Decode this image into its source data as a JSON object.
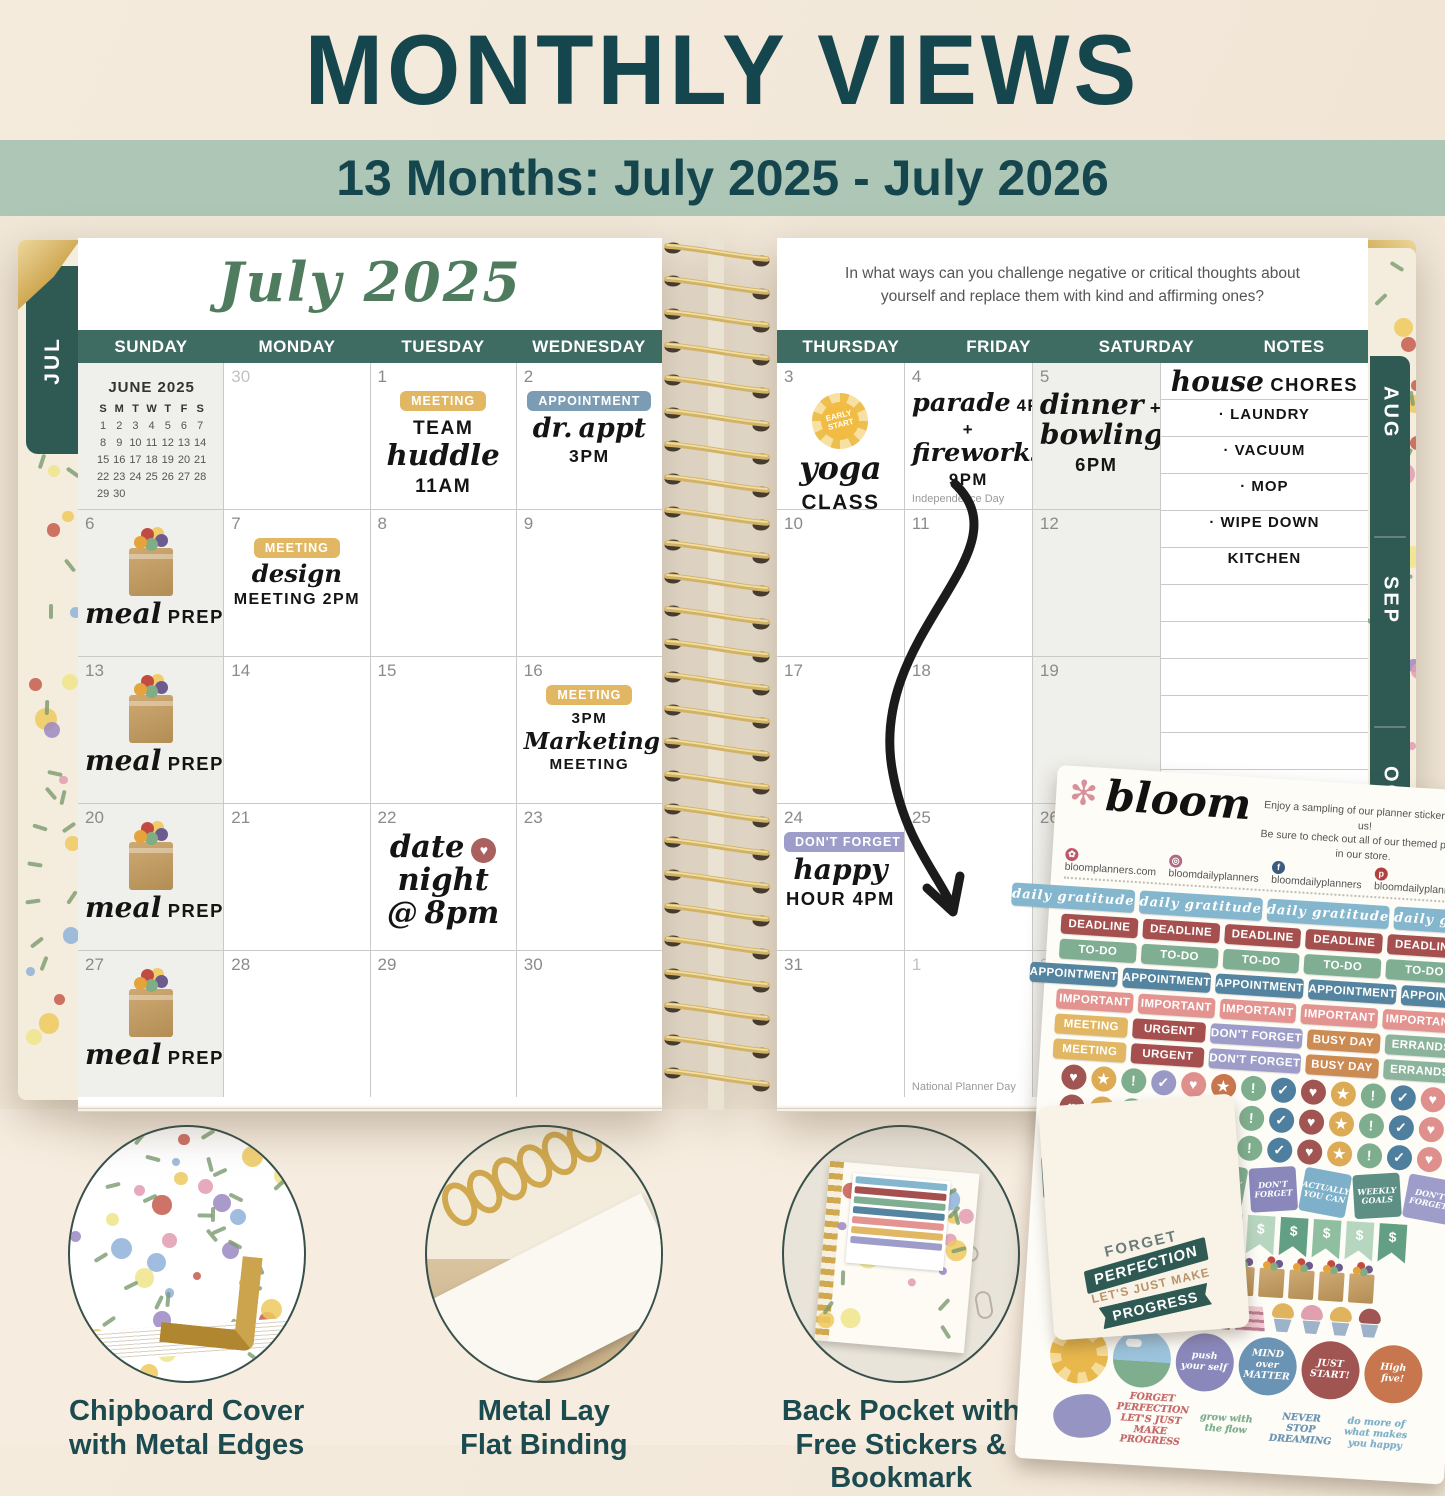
{
  "header": {
    "title": "MONTHLY VIEWS",
    "subtitle": "13 Months: July 2025 - July 2026"
  },
  "palette": {
    "title_teal": "#15454d",
    "band_green": "#adc6b5",
    "header_teal": "#3e6b62",
    "tab_teal": "#2f5a54",
    "script_green": "#4f7b5e",
    "gold_binding": "#d2b366"
  },
  "left_page": {
    "tab": "JUL",
    "month_title": "July 2025",
    "day_headers": [
      "SUNDAY",
      "MONDAY",
      "TUESDAY",
      "WEDNESDAY"
    ],
    "mini_calendar": {
      "title": "JUNE 2025",
      "day_letters": [
        "S",
        "M",
        "T",
        "W",
        "T",
        "F",
        "S"
      ],
      "weeks": [
        [
          "1",
          "2",
          "3",
          "4",
          "5",
          "6",
          "7"
        ],
        [
          "8",
          "9",
          "10",
          "11",
          "12",
          "13",
          "14"
        ],
        [
          "15",
          "16",
          "17",
          "18",
          "19",
          "20",
          "21"
        ],
        [
          "22",
          "23",
          "24",
          "25",
          "26",
          "27",
          "28"
        ],
        [
          "29",
          "30",
          "",
          "",
          "",
          "",
          ""
        ]
      ]
    },
    "cells": [
      {
        "mini": true
      },
      {
        "day": "30",
        "muted": true
      },
      {
        "day": "1",
        "items": [
          {
            "k": "sticker",
            "label": "MEETING",
            "color": "#e2b763"
          },
          {
            "k": "hand",
            "size": 24,
            "lines": [
              "TEAM",
              "huddle",
              "11AM"
            ]
          }
        ]
      },
      {
        "day": "2",
        "items": [
          {
            "k": "sticker",
            "label": "APPOINTMENT",
            "color": "#7b9cb3"
          },
          {
            "k": "hand",
            "size": 22,
            "lines": [
              "dr. appt",
              "3PM"
            ]
          }
        ]
      },
      {
        "day": "6",
        "items": [
          {
            "k": "bag"
          },
          {
            "k": "hand",
            "size": 23,
            "lines": [
              "meal PREP"
            ]
          }
        ]
      },
      {
        "day": "7",
        "items": [
          {
            "k": "sticker",
            "label": "MEETING",
            "color": "#e2b763"
          },
          {
            "k": "hand",
            "size": 20,
            "lines": [
              "design",
              "MEETING 2PM"
            ]
          }
        ]
      },
      {
        "day": "8"
      },
      {
        "day": "9"
      },
      {
        "day": "13",
        "items": [
          {
            "k": "bag"
          },
          {
            "k": "hand",
            "size": 23,
            "lines": [
              "meal PREP"
            ]
          }
        ]
      },
      {
        "day": "14"
      },
      {
        "day": "15"
      },
      {
        "day": "16",
        "items": [
          {
            "k": "sticker",
            "label": "MEETING",
            "color": "#e2b763"
          },
          {
            "k": "hand",
            "size": 19,
            "lines": [
              "3PM",
              "Marketing",
              "MEETING"
            ]
          }
        ]
      },
      {
        "day": "20",
        "items": [
          {
            "k": "bag"
          },
          {
            "k": "hand",
            "size": 23,
            "lines": [
              "meal PREP"
            ]
          }
        ]
      },
      {
        "day": "21"
      },
      {
        "day": "22",
        "items": [
          {
            "k": "hand",
            "size": 25,
            "lines": [
              "date ♥",
              "night",
              "@ 8pm"
            ]
          }
        ]
      },
      {
        "day": "23"
      },
      {
        "day": "27",
        "items": [
          {
            "k": "bag"
          },
          {
            "k": "hand",
            "size": 23,
            "lines": [
              "meal PREP"
            ]
          }
        ]
      },
      {
        "day": "28"
      },
      {
        "day": "29"
      },
      {
        "day": "30"
      }
    ]
  },
  "right_page": {
    "prompt": "In what ways can you challenge negative or critical thoughts about yourself and replace them with kind and affirming ones?",
    "day_headers": [
      "THURSDAY",
      "FRIDAY",
      "SATURDAY",
      "NOTES"
    ],
    "tabs": [
      "AUG",
      "SEP",
      "OCT"
    ],
    "notes": {
      "title": "house CHORES",
      "items": [
        "LAUNDRY",
        "VACUUM",
        "MOP",
        "WIPE DOWN KITCHEN"
      ]
    },
    "cells": [
      {
        "day": "3",
        "items": [
          {
            "k": "sun",
            "text": "EARLY START"
          },
          {
            "k": "hand",
            "size": 26,
            "lines": [
              "yoga",
              "CLASS"
            ]
          }
        ]
      },
      {
        "day": "4",
        "items": [
          {
            "k": "hand",
            "size": 21,
            "lines": [
              "parade 4PM",
              "+",
              "fireworks",
              "9PM"
            ]
          },
          {
            "k": "note",
            "text": "Independence Day"
          }
        ]
      },
      {
        "day": "5",
        "items": [
          {
            "k": "hand",
            "size": 23,
            "lines": [
              "dinner +",
              "bowling",
              "6PM"
            ]
          }
        ]
      },
      {
        "day": "10"
      },
      {
        "day": "11"
      },
      {
        "day": "12"
      },
      {
        "day": "17"
      },
      {
        "day": "18"
      },
      {
        "day": "19"
      },
      {
        "day": "24",
        "items": [
          {
            "k": "sticker",
            "label": "DON'T FORGET",
            "color": "#9e9dc9"
          },
          {
            "k": "hand",
            "size": 23,
            "lines": [
              "happy",
              "HOUR 4PM"
            ]
          }
        ]
      },
      {
        "day": "25"
      },
      {
        "day": "26"
      },
      {
        "day": "31"
      },
      {
        "day": "1",
        "muted": true,
        "items": [
          {
            "k": "note",
            "text": "National Planner Day"
          }
        ]
      },
      {
        "day": "2",
        "muted": true
      }
    ]
  },
  "sticker_sheet": {
    "brand": "bloom",
    "blurb1": "Enjoy a sampling of our planner stickers, on us!",
    "blurb2": "Be sure to check out all of our themed packs in our store.",
    "social": [
      {
        "icon": "flower",
        "color": "#c0566b",
        "text": "bloomplanners.com"
      },
      {
        "icon": "instagram",
        "color": "#b06a84",
        "text": "bloomdailyplanners"
      },
      {
        "icon": "facebook",
        "color": "#3e5a7e",
        "text": "bloomdailyplanners"
      },
      {
        "icon": "pinterest",
        "color": "#b0413e",
        "text": "bloomdailyplanners"
      }
    ],
    "gratitude_row": {
      "label": "daily gratitude",
      "color": "#84b6ce",
      "count": 4
    },
    "label_rows": [
      {
        "label": "DEADLINE",
        "color": "#a5504f",
        "count": 5
      },
      {
        "label": "TO-DO",
        "color": "#80ae93",
        "count": 5
      },
      {
        "label": "APPOINTMENT",
        "color": "#54849f",
        "count": 5
      },
      {
        "label": "IMPORTANT",
        "color": "#e39490",
        "count": 5
      }
    ],
    "mixed_row": [
      {
        "label": "MEETING",
        "color": "#e2b763"
      },
      {
        "label": "URGENT",
        "color": "#a5504f"
      },
      {
        "label": "DON'T FORGET",
        "color": "#9e9dc9"
      },
      {
        "label": "BUSY DAY",
        "color": "#cc8b52"
      },
      {
        "label": "ERRANDS",
        "color": "#8cb49c"
      }
    ],
    "mixed_row_repeat": 2,
    "dot_rows": 3,
    "dot_glyphs": [
      "♥",
      "★",
      "!",
      "✓"
    ],
    "dot_colors": [
      "#a05552",
      "#ddab55",
      "#7fae8e",
      "#9a99c6",
      "#df8f8c",
      "#c7764d",
      "#7fae8e",
      "#4e7f9e",
      "#a05552",
      "#ddab55",
      "#7fae8e",
      "#4e7f9e",
      "#df8f8c"
    ],
    "square_row": [
      {
        "label": "WEEKLY GOALS",
        "color": "#5d8f84"
      },
      {
        "label": "DON'T FORGET",
        "color": "#9e9dc9"
      },
      {
        "label": "ACTUALLY YOU CAN",
        "color": "#7fb0c9"
      },
      {
        "label": "WEEKLY GOALS",
        "color": "#80ae93"
      },
      {
        "label": "DON'T FORGET",
        "color": "#8a88bb"
      },
      {
        "label": "ACTUALLY YOU CAN",
        "color": "#7fb0c9"
      },
      {
        "label": "WEEKLY GOALS",
        "color": "#5d8f84"
      },
      {
        "label": "DON'T FORGET",
        "color": "#9e9dc9"
      }
    ],
    "flag_row": {
      "glyph": "$",
      "count": 10,
      "colors": [
        "#63a083",
        "#8fbfa0",
        "#b7d6c0"
      ]
    },
    "bag_count": 9,
    "cake_row": [
      "slice",
      "slice-choc",
      "slice",
      "slice-choc",
      "slice",
      "cupcake-gold",
      "cupcake-pink",
      "cupcake-gold",
      "cupcake-red"
    ],
    "round_row": [
      {
        "kind": "sun",
        "label": ""
      },
      {
        "kind": "scene",
        "label": ""
      },
      {
        "label": "push your self",
        "color": "#8a88bb"
      },
      {
        "label": "MIND over MATTER",
        "color": "#6b93b4"
      },
      {
        "label": "JUST START!",
        "color": "#a05552"
      },
      {
        "label": "High five!",
        "color": "#c7764d"
      }
    ],
    "script_row": [
      {
        "label": "",
        "color": "#8a88bb"
      },
      {
        "label": "FORGET PERFECTION LET'S JUST MAKE PROGRESS",
        "color": "#c56a6a"
      },
      {
        "label": "grow with the flow",
        "color": "#7fae8e"
      },
      {
        "label": "NEVER STOP DREAMING",
        "color": "#6b93b4"
      },
      {
        "label": "do more of what makes you happy",
        "color": "#7fb0c9"
      }
    ]
  },
  "bookmark": {
    "lines": [
      "FORGET",
      "PERFECTION",
      "LET'S JUST MAKE",
      "PROGRESS"
    ]
  },
  "features": [
    {
      "kind": "cover",
      "caption_lines": [
        "Chipboard Cover",
        "with Metal Edges"
      ]
    },
    {
      "kind": "binding",
      "caption_lines": [
        "Metal Lay",
        "Flat Binding"
      ]
    },
    {
      "kind": "pocket",
      "caption_lines": [
        "Back Pocket with",
        "Free Stickers & Bookmark"
      ]
    },
    {
      "kind": "tabs",
      "caption_lines": [
        "Laminated",
        "Monthly Tabs"
      ],
      "tab_labels": [
        "FEB",
        "MAR",
        "APR"
      ],
      "flag": "20"
    }
  ]
}
